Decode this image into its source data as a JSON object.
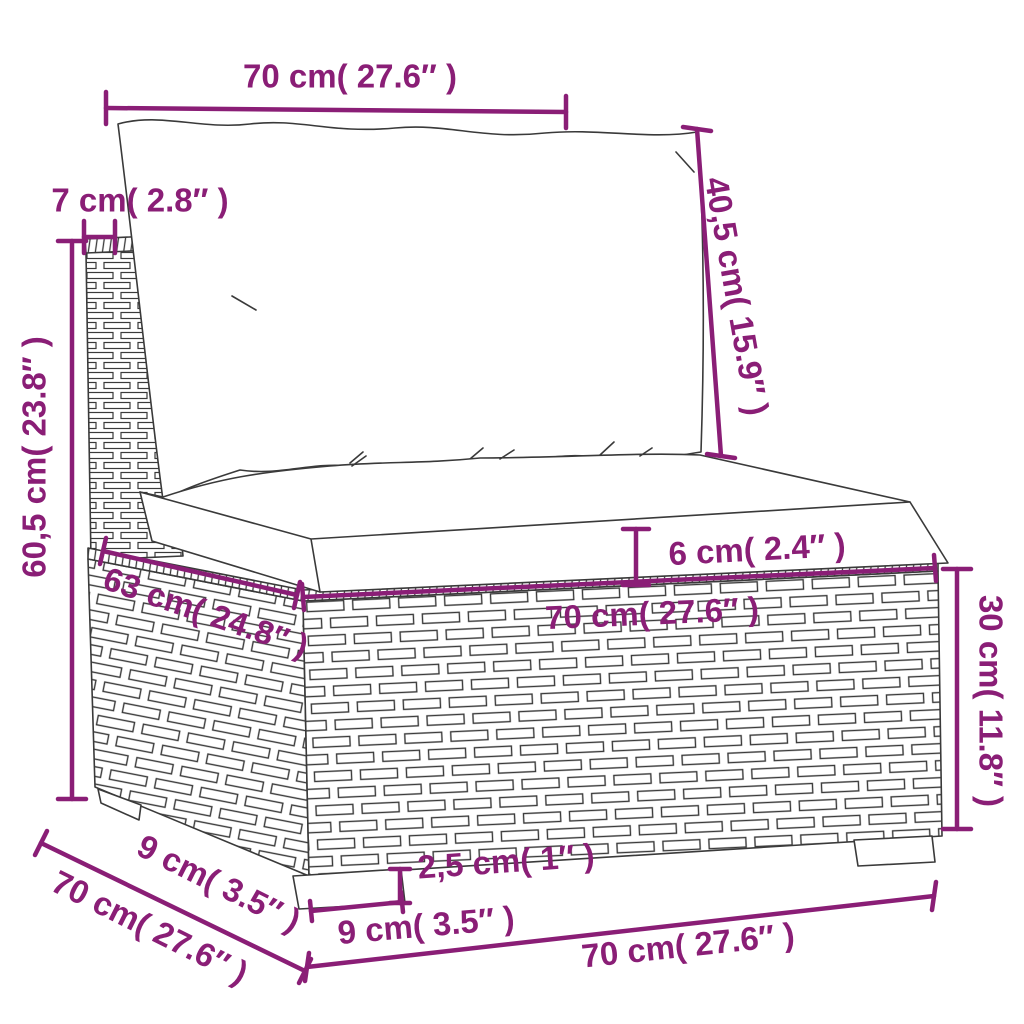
{
  "diagram": {
    "background": "#FFFFFF",
    "colors": {
      "dimension_accent": "#8A1E76",
      "line_art": "#3A3A3A"
    },
    "labels": {
      "back_cushion_width": "70 cm( 27.6″ )",
      "back_cushion_height": "40,5 cm( 15.9″ )",
      "back_frame_thickness": "7 cm( 2.8″ )",
      "total_height": "60,5 cm( 23.8″ )",
      "seat_cushion_thickness": "6 cm( 2.4″ )",
      "seat_depth": "63 cm( 24.8″ )",
      "seat_width": "70 cm( 27.6″ )",
      "base_height": "30 cm( 11.8″ )",
      "side_leg_width": "9 cm( 3.5″ )",
      "side_depth": "70 cm( 27.6″ )",
      "leg_height": "2,5 cm( 1″ )",
      "front_leg_width": "9 cm( 3.5″ )",
      "front_width": "70 cm( 27.6″ )"
    }
  }
}
